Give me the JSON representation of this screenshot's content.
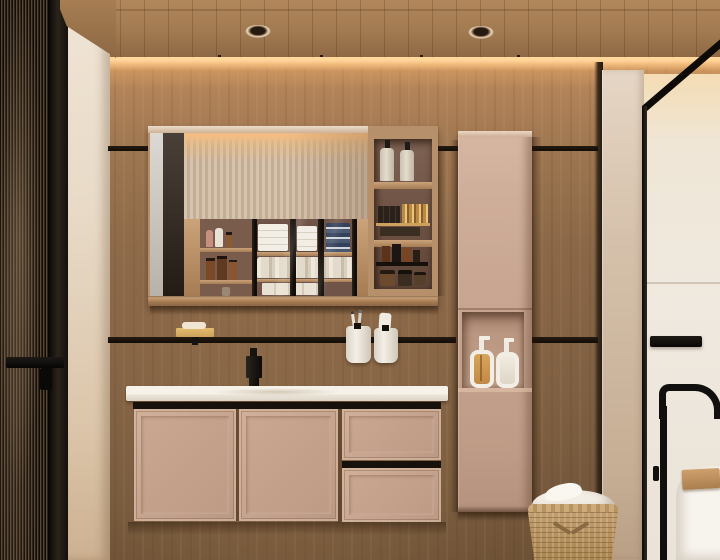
{
  "scene": {
    "type": "photorealistic interior render",
    "room": "modern wood-clad bathroom",
    "description": "Warm wood bathroom wall with floating taupe vanity and white countertop, black faucet, mirror cabinet with glass shelving, open shelf tower, tall column cabinet with dispenser niche, reeded glass door at left, framed shower glass at right with freestanding black tub filler and white tub, woven laundry basket with towel."
  },
  "palette": {
    "wood_mid": "#8a6747",
    "wood_ceiling": "#a07950",
    "cove_glow": "#ffd79b",
    "cream_wall": "#f0e4d5",
    "glass_door": "#2c2218",
    "mirror_flute": "#d6c3ae",
    "interior_dark": "#6f5447",
    "shelf_interior": "#5f4537",
    "cabinet_beige": "#c5a38e",
    "niche_interior": "#c2a08a",
    "counter_white": "#f6f2ea",
    "rail_black": "#17110b",
    "towel_white": "#f2ede5",
    "tin_navy": "#33415c",
    "gold_accent": "#cda15c",
    "pilaster": "#d5c1ab",
    "shower_wall": "#efe9df",
    "tub_white": "#f7f4ee",
    "tray_wood": "#ab7e4f",
    "basket_tan": "#c29e70"
  },
  "objects": [
    {
      "name": "ceiling",
      "label": "Wood slat ceiling"
    },
    {
      "name": "ceiling-light-left",
      "label": "Recessed spotlight"
    },
    {
      "name": "ceiling-light-right",
      "label": "Recessed spotlight"
    },
    {
      "name": "cove-light",
      "label": "Warm LED cove strip"
    },
    {
      "name": "fluted-glass-door",
      "label": "Reeded glass door with black frame"
    },
    {
      "name": "door-handle",
      "label": "Black door handle"
    },
    {
      "name": "mirror-cabinet",
      "label": "Mirror cabinet with glass-front shelves"
    },
    {
      "name": "towel-stacks",
      "label": "Folded white towels"
    },
    {
      "name": "canister-row",
      "label": "White ribbed storage canisters"
    },
    {
      "name": "tin-stack",
      "label": "Stacked navy tins"
    },
    {
      "name": "cosmetic-shelf",
      "label": "Small shelf with cosmetic bottles"
    },
    {
      "name": "open-shelf-tower",
      "label": "Open shelf unit with toiletries"
    },
    {
      "name": "pump-bottles",
      "label": "Two cream pump bottles with black caps"
    },
    {
      "name": "perfume-tray",
      "label": "Gold minis and dark boxes on brass tray"
    },
    {
      "name": "tall-cabinet",
      "label": "Tall taupe column cabinet"
    },
    {
      "name": "niche-dispensers",
      "label": "Two square soap dispensers in niche"
    },
    {
      "name": "vanity-counter",
      "label": "White stone countertop with integrated sink"
    },
    {
      "name": "faucet",
      "label": "Matte black faucet"
    },
    {
      "name": "vanity-doors",
      "label": "Vanity cabinet doors"
    },
    {
      "name": "vanity-drawers",
      "label": "Vanity drawers with black pull"
    },
    {
      "name": "hanging-rail",
      "label": "Black wall rail"
    },
    {
      "name": "soap-tray",
      "label": "Brass soap tray with soap bar"
    },
    {
      "name": "toothbrush-cups",
      "label": "Two white cups with toothbrushes"
    },
    {
      "name": "laundry-basket",
      "label": "Woven laundry basket"
    },
    {
      "name": "basket-towel",
      "label": "White towel in basket"
    },
    {
      "name": "shower-glass",
      "label": "Black framed shower glass panel"
    },
    {
      "name": "glass-handle",
      "label": "Black glass door handle"
    },
    {
      "name": "tub-filler",
      "label": "Black freestanding tub filler"
    },
    {
      "name": "bathtub",
      "label": "White freestanding bathtub"
    },
    {
      "name": "bath-tray",
      "label": "Wooden bath tray"
    },
    {
      "name": "pilaster",
      "label": "Beige corner pilaster"
    }
  ]
}
